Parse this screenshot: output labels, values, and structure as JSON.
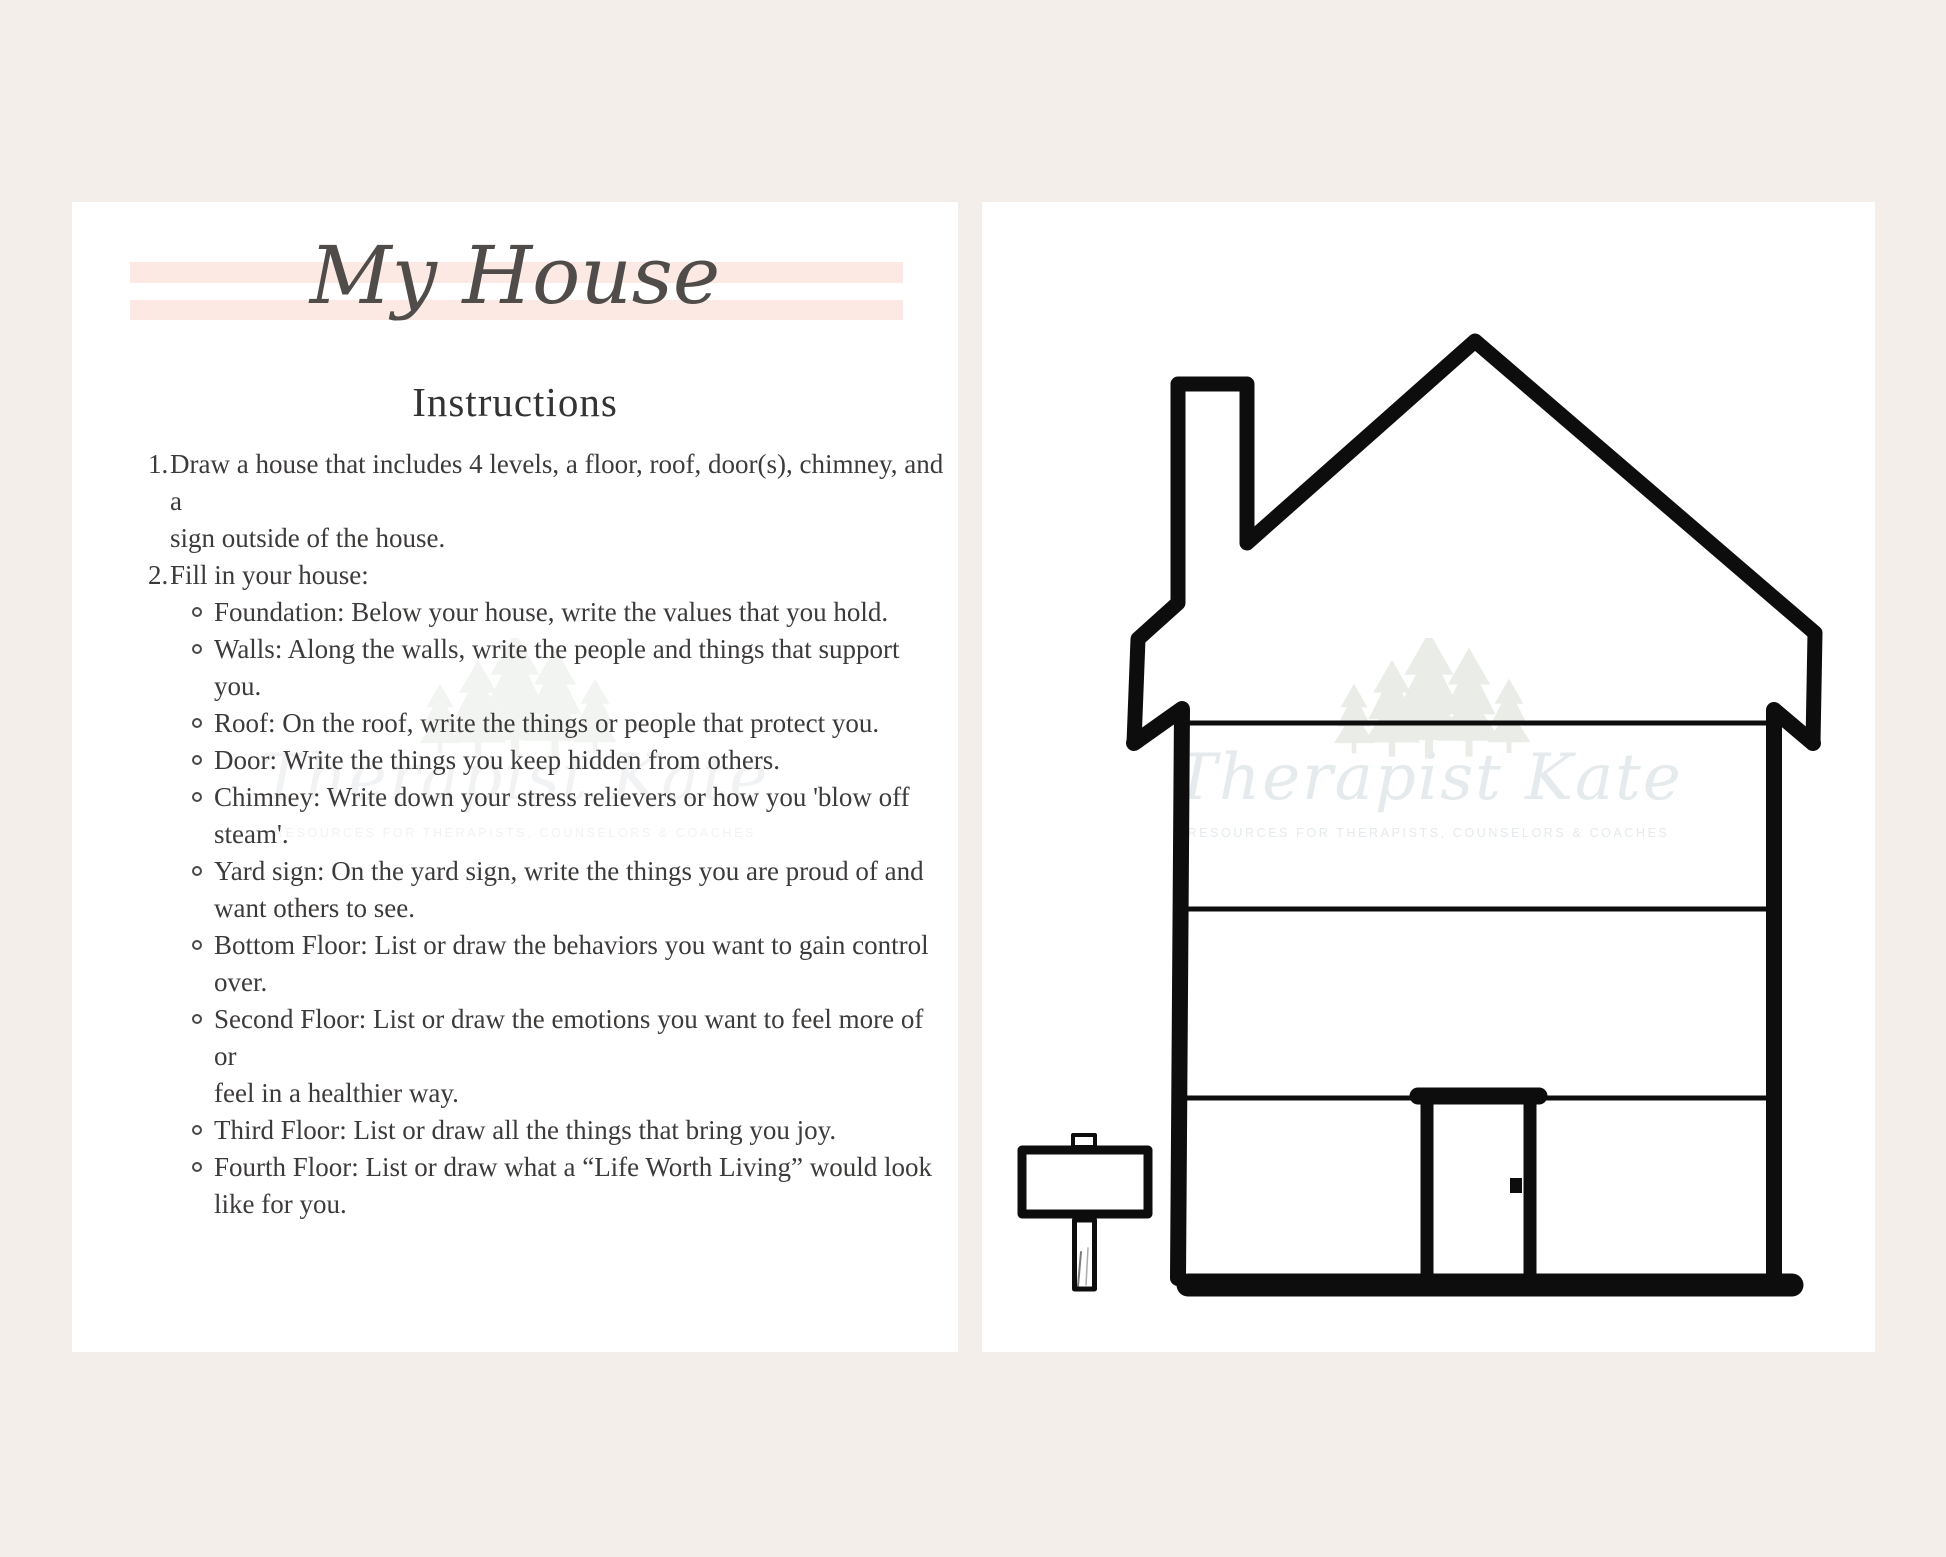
{
  "colors": {
    "background": "#f4eeea",
    "page": "#ffffff",
    "ink": "#0d0d0d",
    "stripe": "#fce9e4",
    "body-text": "#3d3b3a",
    "title-text": "#504c49",
    "watermark-text": "#e4e9ec",
    "watermark-tree": "#e8ece6"
  },
  "left_page": {
    "title": "My House",
    "heading": "Instructions",
    "items": [
      {
        "number": "1.",
        "text": "Draw a house that includes 4 levels, a floor, roof, door(s), chimney, and a\nsign outside of the house."
      },
      {
        "number": "2.",
        "text": "Fill in your house:",
        "sub_items": [
          "Foundation: Below your house, write the values that you hold.",
          "Walls: Along the walls, write the people and things that support\nyou.",
          "Roof: On the roof, write the things or people that protect you.",
          "Door: Write the things you keep hidden from others.",
          "Chimney: Write down your stress relievers or how you 'blow off\nsteam'.",
          "Yard sign: On the yard sign, write the things you are proud of and\nwant others to see.",
          "Bottom Floor: List or draw the behaviors you want to gain control\nover.",
          "Second Floor: List or draw the emotions you want to feel more of or\nfeel in a healthier way.",
          "Third Floor: List or draw all the things that bring you joy.",
          "Fourth Floor: List or draw what a “Life Worth Living” would look\nlike for you."
        ]
      }
    ]
  },
  "watermark": {
    "script": "Therapist Kate",
    "caption": "RESOURCES FOR THERAPISTS, COUNSELORS & COACHES"
  }
}
